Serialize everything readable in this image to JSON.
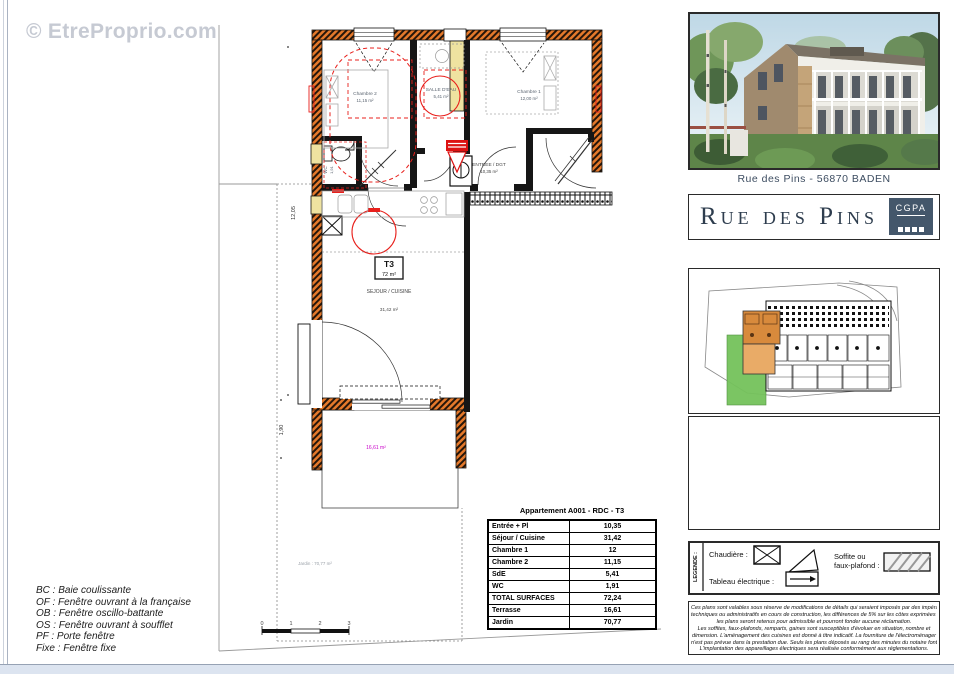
{
  "watermark": "© EtreProprio.com",
  "plan": {
    "rooms": {
      "chambre2": {
        "name": "Chambre 2",
        "area": "11,15 m²"
      },
      "salle_eau": {
        "name": "SALLE D'EAU",
        "area": "5,41 m²"
      },
      "chambre1": {
        "name": "Chambre 1",
        "area": "12,00 m²"
      },
      "entree": {
        "name": "ENTREE / DGT",
        "area": "10,35 m²"
      },
      "sejour": {
        "name": "SEJOUR / CUISINE",
        "area": "31,42 m²"
      },
      "wc": {
        "name": "WC",
        "area": "1,91"
      }
    },
    "type_box": {
      "label": "T3",
      "area": "72 m²"
    },
    "terrasse_area": "16,61 m²",
    "jardin_label": "Jardin : 70,77 m²",
    "dimensions": {
      "left": "12,05",
      "terrace": "1,90"
    },
    "scale_ticks": [
      "0",
      "1",
      "2",
      "3"
    ]
  },
  "abbreviations": [
    "BC : Baie coulissante",
    "OF : Fenêtre ouvrant à la française",
    "OB : Fenêtre oscillo-battante",
    "OS : Fenêtre ouvrant à soufflet",
    "PF : Porte fenêtre",
    "Fixe : Fenêtre fixe"
  ],
  "surface_table": {
    "title": "Appartement A001 - RDC - T3",
    "rows": [
      [
        "Entrée + Pl",
        "10,35"
      ],
      [
        "Séjour / Cuisine",
        "31,42"
      ],
      [
        "Chambre 1",
        "12"
      ],
      [
        "Chambre 2",
        "11,15"
      ],
      [
        "SdE",
        "5,41"
      ],
      [
        "WC",
        "1,91"
      ],
      [
        "TOTAL SURFACES",
        "72,24"
      ],
      [
        "Terrasse",
        "16,61"
      ],
      [
        "Jardin",
        "70,77"
      ]
    ]
  },
  "sidebar": {
    "photo_caption": "Rue des Pins - 56870 BADEN",
    "project_title": "Rue des Pins",
    "logo_text": "CGPA",
    "legend": {
      "label": "LEGENDE :",
      "chaudiere_label": "Chaudière :",
      "tableau_label": "Tableau électrique :",
      "soffite_label_1": "Soffite ou",
      "soffite_label_2": "faux-plafond :"
    },
    "disclaimer": [
      "Ces plans sont valables sous réserve de modifications de détails qui seraient imposés par des impératifs",
      "techniques ou administratifs en cours de construction, les différences de 5% sur les côtes exprimées par",
      "les plans seront retenus pour admissible et pourront fonder aucune réclamation.",
      "Les soffites, faux-plafonds, remparts, gaines sont susceptibles d'évoluer en situation, nombre et",
      "dimension. L'aménagement des cuisines est donné à titre indicatif. La fourniture de l'électroménager",
      "n'est pas prévue dans la prestation due. Seuls les plans déposés au rang des minutes du notaire font foi.",
      "L'implantation des appareillages électriques sera réalisée conformément aux réglementations."
    ]
  },
  "colors": {
    "wall_hatch": "#e5792b",
    "highlight_unit": "#d88a3c",
    "highlight_garden": "#74c25b",
    "soffite_red": "#e8201c",
    "terrasse_label": "#c800c8",
    "logo_bg": "#44576b"
  }
}
